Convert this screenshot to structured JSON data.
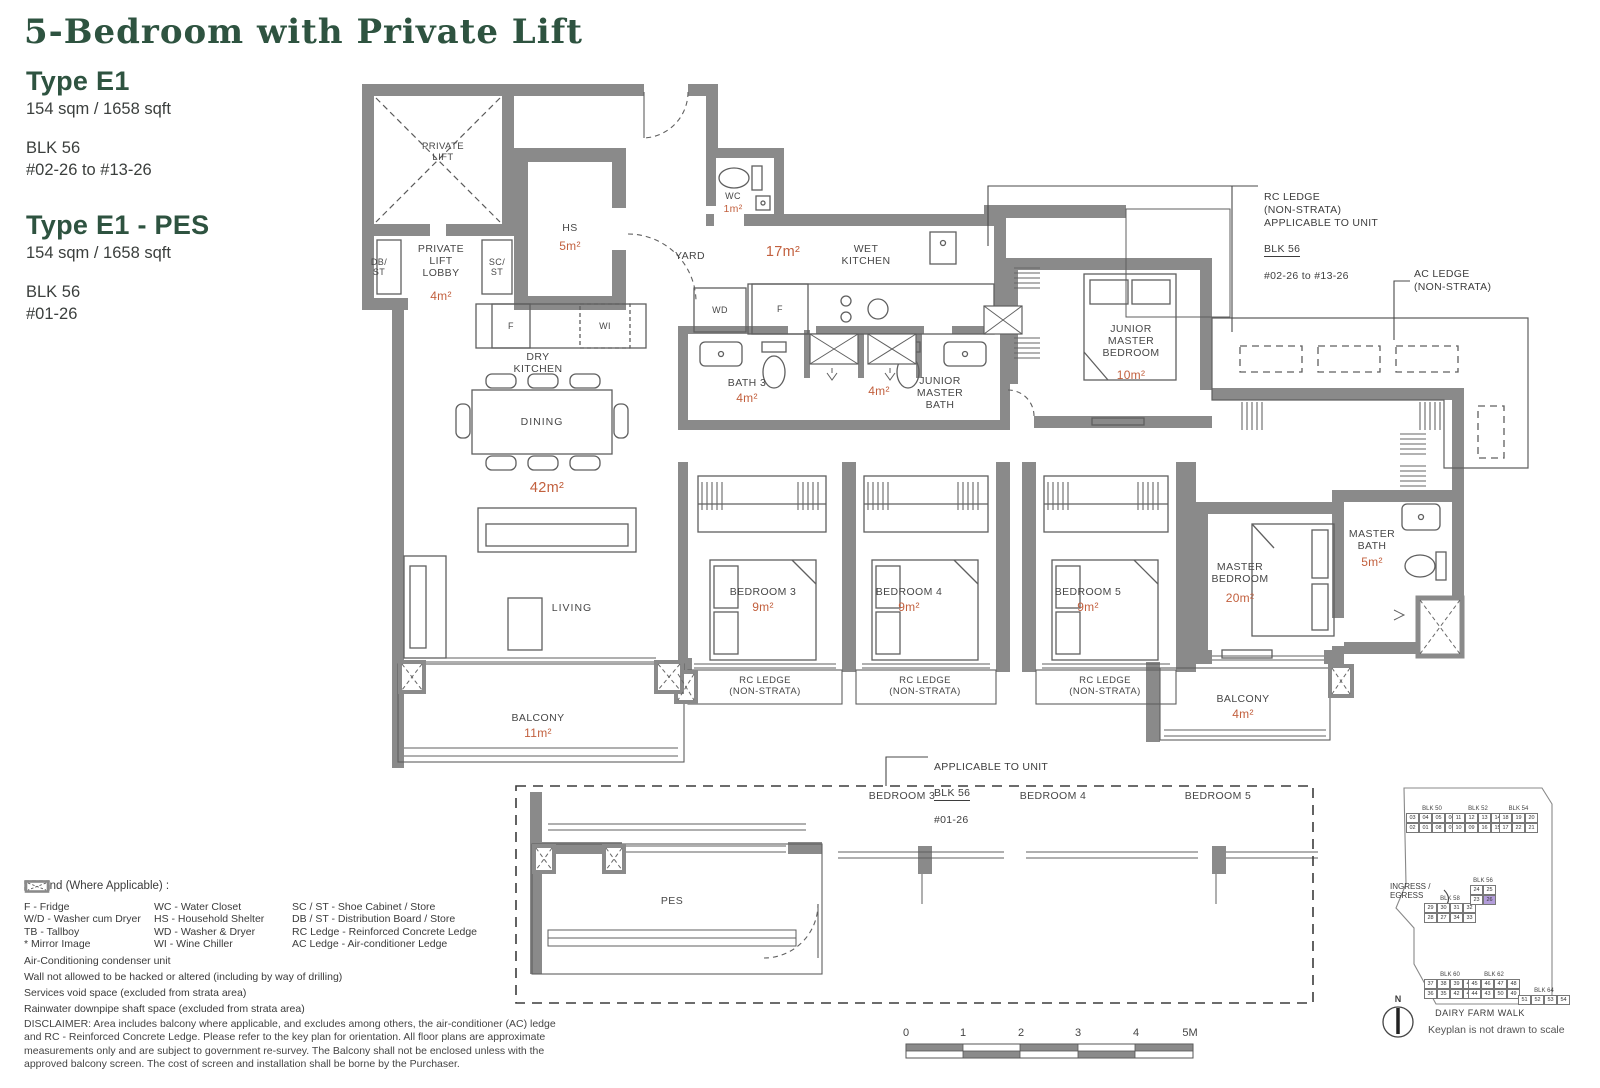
{
  "colors": {
    "accent_green": "#2e5340",
    "area_orange": "#c2603e",
    "wall_gray": "#8a8a8a",
    "keyplan_highlight": "#b39ddb"
  },
  "header": {
    "title": "5-Bedroom with Private Lift",
    "types": [
      {
        "name": "Type E1",
        "size": "154 sqm / 1658 sqft",
        "block": "BLK 56",
        "units": "#02-26 to #13-26"
      },
      {
        "name": "Type E1 - PES",
        "size": "154 sqm / 1658 sqft",
        "block": "BLK 56",
        "units": "#01-26"
      }
    ]
  },
  "plan": {
    "labels": {
      "private_lift": "PRIVATE\nLIFT",
      "db_st": "DB/\nST",
      "lift_lobby": "PRIVATE\nLIFT\nLOBBY",
      "lift_lobby_area": "4m²",
      "sc_st": "SC/\nST",
      "hs": "HS",
      "hs_area": "5m²",
      "wc": "WC",
      "wc_area": "1m²",
      "yard": "YARD",
      "kitchen_area": "17m²",
      "wet_kitchen": "WET\nKITCHEN",
      "wd": "WD",
      "fridge": "F",
      "dry_kitchen": "DRY\nKITCHEN",
      "dry_fridge": "F",
      "wine_chiller": "WI",
      "dining": "DINING",
      "living_dining_area": "42m²",
      "living": "LIVING",
      "bath3": "BATH 3",
      "bath3_area": "4m²",
      "jmb_bath_area": "4m²",
      "junior_master_bath": "JUNIOR\nMASTER\nBATH",
      "junior_master_bedroom": "JUNIOR\nMASTER\nBEDROOM",
      "junior_master_bedroom_area": "10m²",
      "bedroom3": "BEDROOM 3",
      "bedroom4": "BEDROOM 4",
      "bedroom5": "BEDROOM 5",
      "bedroom_area": "9m²",
      "rc_ledge": "RC LEDGE\n(NON-STRATA)",
      "master_bedroom": "MASTER\nBEDROOM",
      "master_bedroom_area": "20m²",
      "master_bath": "MASTER\nBATH",
      "master_bath_area": "5m²",
      "balcony": "BALCONY",
      "balcony_main_area": "11m²",
      "balcony_master_area": "4m²",
      "pes": "PES"
    },
    "annotations": {
      "rc_ledge_note": "RC LEDGE\n(NON-STRATA)\nAPPLICABLE TO UNIT",
      "rc_ledge_note_block": "BLK 56",
      "rc_ledge_note_units": "#02-26 to #13-26",
      "ac_ledge_note": "AC LEDGE\n(NON-STRATA)",
      "pes_note": "APPLICABLE TO UNIT",
      "pes_note_block": "BLK 56",
      "pes_note_units": "#01-26"
    }
  },
  "legend": {
    "heading": "Legend (Where Applicable) :",
    "columns": [
      [
        "F - Fridge",
        "W/D - Washer cum Dryer",
        "TB - Tallboy",
        "* Mirror Image"
      ],
      [
        "WC - Water Closet",
        "HS - Household Shelter",
        "WD - Washer & Dryer",
        "WI - Wine Chiller"
      ],
      [
        "SC / ST - Shoe Cabinet / Store",
        "DB / ST - Distribution Board / Store",
        "RC Ledge - Reinforced Concrete Ledge",
        "AC Ledge - Air-conditioner Ledge"
      ]
    ],
    "symbols": [
      "Air-Conditioning condenser unit",
      "Wall not allowed to be hacked or altered (including by way of drilling)",
      "Services void space (excluded from strata area)",
      "Rainwater downpipe shaft space (excluded from strata area)"
    ]
  },
  "disclaimer": "DISCLAIMER: Area includes balcony where applicable, and excludes among others, the air-conditioner (AC) ledge and RC - Reinforced Concrete Ledge. Please refer to the key plan for orientation. All floor plans are approximate measurements only and are subject to government re-survey. The Balcony shall not be enclosed unless with the approved balcony screen. The cost of screen and installation shall be borne by the Purchaser.",
  "scale_bar": {
    "ticks": [
      "0",
      "1",
      "2",
      "3",
      "4",
      "5M"
    ]
  },
  "keyplan": {
    "ingress": "INGRESS /\nEGRESS",
    "road": "DAIRY FARM WALK",
    "note": "Keyplan is not drawn to scale",
    "compass": "N",
    "highlight_block": "BLK 56",
    "highlight_unit": "26",
    "blocks": [
      {
        "name": "BLK 50",
        "rows": [
          [
            "03",
            "04",
            "05",
            "06"
          ],
          [
            "02",
            "01",
            "08",
            "07"
          ]
        ]
      },
      {
        "name": "BLK 52",
        "rows": [
          [
            "11",
            "12",
            "13",
            "14"
          ],
          [
            "10",
            "09",
            "16",
            "15"
          ]
        ]
      },
      {
        "name": "BLK 54",
        "rows": [
          [
            "18",
            "19",
            "20"
          ],
          [
            "17",
            "22",
            "21"
          ]
        ]
      },
      {
        "name": "BLK 58",
        "rows": [
          [
            "29",
            "30",
            "31",
            "32"
          ],
          [
            "28",
            "27",
            "34",
            "33"
          ]
        ]
      },
      {
        "name": "BLK 56",
        "rows": [
          [
            "24",
            "25"
          ],
          [
            "23",
            "26"
          ]
        ]
      },
      {
        "name": "BLK 60",
        "rows": [
          [
            "37",
            "38",
            "39",
            "40"
          ],
          [
            "36",
            "35",
            "42",
            "41"
          ]
        ]
      },
      {
        "name": "BLK 62",
        "rows": [
          [
            "45",
            "46",
            "47",
            "48"
          ],
          [
            "44",
            "43",
            "50",
            "49"
          ]
        ]
      },
      {
        "name": "BLK 64",
        "rows": [
          [
            "51",
            "52",
            "53",
            "54"
          ]
        ]
      }
    ]
  }
}
